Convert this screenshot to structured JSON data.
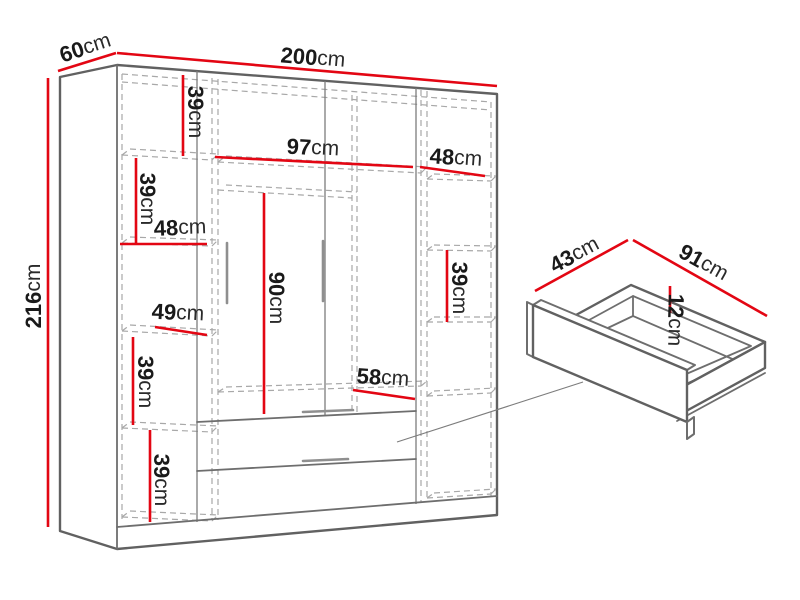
{
  "diagram": {
    "title": "wardrobe dimension diagram",
    "unit": "cm",
    "colors": {
      "dimension_line": "#e30613",
      "edge": "#6e6e6e",
      "hidden_line": "#a8a8a8",
      "label_text": "#1a1a1a",
      "background": "#ffffff"
    },
    "wardrobe": {
      "overall": {
        "width_cm": 200,
        "depth_cm": 60,
        "height_cm": 216
      },
      "sections": {
        "left_column_compartment_heights_cm": [
          39,
          39,
          49,
          39,
          39
        ],
        "left_column_width_cm": 48,
        "middle_section_width_cm": 97,
        "hanging_space_height_cm": 90,
        "shelf_above_drawers_width_cm": 58,
        "right_column_width_cm": 48,
        "right_column_compartment_height_cm": 39
      },
      "drawer_detail": {
        "width_cm": 91,
        "depth_cm": 43,
        "height_cm": 12
      }
    },
    "labels": {
      "width200": {
        "num": "200",
        "unit": "cm"
      },
      "depth60": {
        "num": "60",
        "unit": "cm"
      },
      "height216": {
        "num": "216",
        "unit": "cm"
      },
      "shelf39a": {
        "num": "39",
        "unit": "cm"
      },
      "shelf39b": {
        "num": "39",
        "unit": "cm"
      },
      "width48left": {
        "num": "48",
        "unit": "cm"
      },
      "height49": {
        "num": "49",
        "unit": "cm"
      },
      "shelf39c": {
        "num": "39",
        "unit": "cm"
      },
      "shelf39d": {
        "num": "39",
        "unit": "cm"
      },
      "width97": {
        "num": "97",
        "unit": "cm"
      },
      "height90": {
        "num": "90",
        "unit": "cm"
      },
      "width58": {
        "num": "58",
        "unit": "cm"
      },
      "width48right": {
        "num": "48",
        "unit": "cm"
      },
      "shelf39right": {
        "num": "39",
        "unit": "cm"
      },
      "drawer43": {
        "num": "43",
        "unit": "cm"
      },
      "drawer91": {
        "num": "91",
        "unit": "cm"
      },
      "drawer12": {
        "num": "12",
        "unit": "cm"
      }
    }
  }
}
